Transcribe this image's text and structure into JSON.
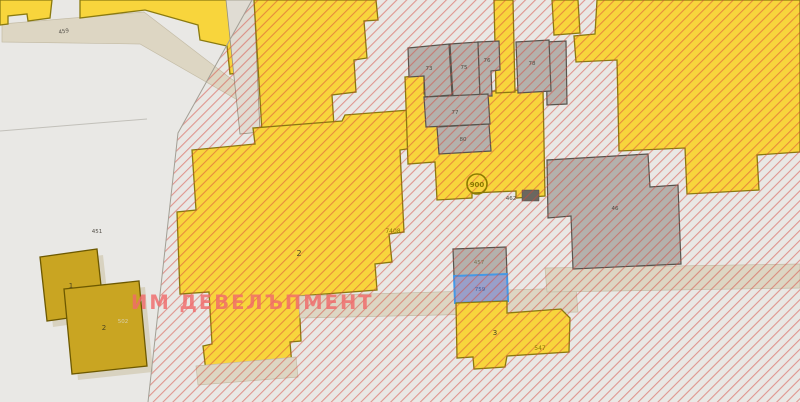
{
  "map": {
    "watermark": "ИМ ДЕВЕЛЪПМЕНТ",
    "labels": {
      "road_459": "459",
      "parcel_451": "451",
      "building_left_1": "1",
      "building_left_2": "2",
      "building_left_2_code": "502",
      "parcel_central": "2",
      "parcel_central_code": "7408",
      "circle_marker": "900",
      "road_462": "462",
      "cluster_building_a": "73",
      "cluster_building_b": "75",
      "cluster_building_c": "76",
      "cluster_building_d": "78",
      "cluster_building_e": "77",
      "cluster_building_f": "80",
      "building_large_right": "46",
      "rect_gray": "457",
      "rect_blue": "759",
      "parcel_south": "3",
      "parcel_south_code": "547"
    },
    "colors": {
      "background": "#e9e8e5",
      "parcel_yellow": "#f8d53c",
      "parcel_border": "#8a7a10",
      "building_gray": "#b4b1ac",
      "building_olive": "#c9a522",
      "blue_parcel_border": "#4498e6",
      "blue_parcel_fill": "#999fc9",
      "hatch_red": "rgba(214,68,58,0.5)",
      "watermark_pink": "rgba(240,106,106,0.82)",
      "beige_road": "#ddd6c3",
      "marker_olive": "#8c7b00"
    }
  }
}
